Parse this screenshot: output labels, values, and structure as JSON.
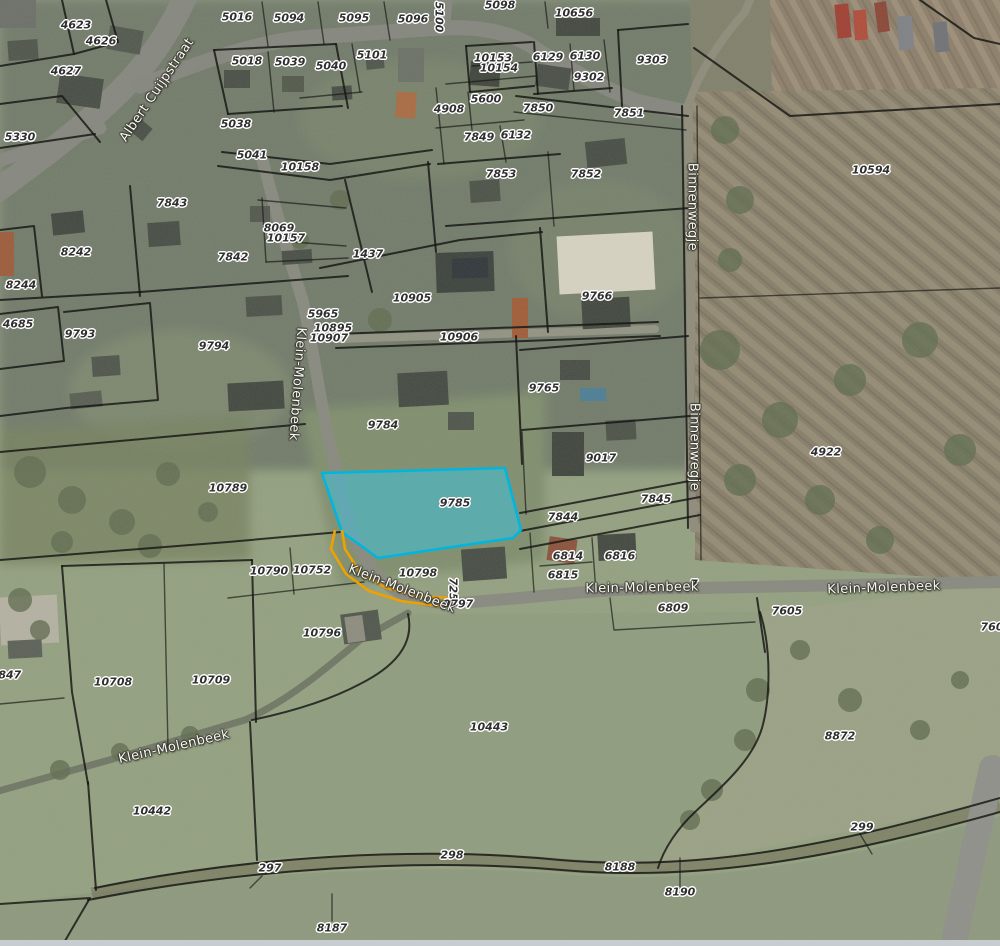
{
  "map": {
    "title": "Cadastral parcel map over aerial photo",
    "highlighted_parcel": {
      "id": "9785",
      "fill": "#40c1da",
      "stroke": "#00b6de"
    },
    "selection_outline_color": "#efa100",
    "parcel_label_color": "#2f2f2f",
    "road_label_color": "#f8f8f2",
    "parcel_labels": [
      {
        "id": "4623",
        "x": 76,
        "y": 25
      },
      {
        "id": "4626",
        "x": 101,
        "y": 41
      },
      {
        "id": "4627",
        "x": 66,
        "y": 71
      },
      {
        "id": "5330",
        "x": 20,
        "y": 137
      },
      {
        "id": "5016",
        "x": 237,
        "y": 17
      },
      {
        "id": "5094",
        "x": 289,
        "y": 18
      },
      {
        "id": "5095",
        "x": 354,
        "y": 18
      },
      {
        "id": "5096",
        "x": 413,
        "y": 19
      },
      {
        "id": "5100",
        "x": 439,
        "y": 17,
        "rot": 90
      },
      {
        "id": "5098",
        "x": 500,
        "y": 5
      },
      {
        "id": "10656",
        "x": 574,
        "y": 13
      },
      {
        "id": "5018",
        "x": 247,
        "y": 61
      },
      {
        "id": "5039",
        "x": 290,
        "y": 62
      },
      {
        "id": "5040",
        "x": 331,
        "y": 66
      },
      {
        "id": "5101",
        "x": 372,
        "y": 55
      },
      {
        "id": "5038",
        "x": 236,
        "y": 124
      },
      {
        "id": "5041",
        "x": 252,
        "y": 155
      },
      {
        "id": "10158",
        "x": 300,
        "y": 167
      },
      {
        "id": "10153",
        "x": 493,
        "y": 58
      },
      {
        "id": "10154",
        "x": 499,
        "y": 68
      },
      {
        "id": "6129",
        "x": 548,
        "y": 57
      },
      {
        "id": "6130",
        "x": 585,
        "y": 56
      },
      {
        "id": "9302",
        "x": 589,
        "y": 77
      },
      {
        "id": "9303",
        "x": 652,
        "y": 60
      },
      {
        "id": "5600",
        "x": 486,
        "y": 99
      },
      {
        "id": "4908",
        "x": 449,
        "y": 109
      },
      {
        "id": "7850",
        "x": 538,
        "y": 108
      },
      {
        "id": "7851",
        "x": 629,
        "y": 113
      },
      {
        "id": "7849",
        "x": 479,
        "y": 137
      },
      {
        "id": "6132",
        "x": 516,
        "y": 135
      },
      {
        "id": "7853",
        "x": 501,
        "y": 174
      },
      {
        "id": "7852",
        "x": 586,
        "y": 174
      },
      {
        "id": "10594",
        "x": 871,
        "y": 170
      },
      {
        "id": "7843",
        "x": 172,
        "y": 203
      },
      {
        "id": "8069",
        "x": 279,
        "y": 228
      },
      {
        "id": "10157",
        "x": 286,
        "y": 238
      },
      {
        "id": "7842",
        "x": 233,
        "y": 257
      },
      {
        "id": "8242",
        "x": 76,
        "y": 252
      },
      {
        "id": "8244",
        "x": 21,
        "y": 285
      },
      {
        "id": "1437",
        "x": 368,
        "y": 254
      },
      {
        "id": "4685",
        "x": 18,
        "y": 324
      },
      {
        "id": "9793",
        "x": 80,
        "y": 334
      },
      {
        "id": "9794",
        "x": 214,
        "y": 346
      },
      {
        "id": "10905",
        "x": 412,
        "y": 298
      },
      {
        "id": "5965",
        "x": 323,
        "y": 314
      },
      {
        "id": "10895",
        "x": 333,
        "y": 328
      },
      {
        "id": "10907",
        "x": 329,
        "y": 338
      },
      {
        "id": "10906",
        "x": 459,
        "y": 337
      },
      {
        "id": "9766",
        "x": 597,
        "y": 296
      },
      {
        "id": "9765",
        "x": 544,
        "y": 388
      },
      {
        "id": "9784",
        "x": 383,
        "y": 425
      },
      {
        "id": "4922",
        "x": 826,
        "y": 452
      },
      {
        "id": "9017",
        "x": 601,
        "y": 458
      },
      {
        "id": "10789",
        "x": 228,
        "y": 488
      },
      {
        "id": "9785",
        "x": 455,
        "y": 503
      },
      {
        "id": "7845",
        "x": 656,
        "y": 499
      },
      {
        "id": "7844",
        "x": 563,
        "y": 517
      },
      {
        "id": "10790",
        "x": 269,
        "y": 571
      },
      {
        "id": "10752",
        "x": 312,
        "y": 570
      },
      {
        "id": "10798",
        "x": 418,
        "y": 573
      },
      {
        "id": "6814",
        "x": 568,
        "y": 556
      },
      {
        "id": "6816",
        "x": 620,
        "y": 556
      },
      {
        "id": "6815",
        "x": 563,
        "y": 575
      },
      {
        "id": "7251",
        "x": 453,
        "y": 593,
        "rot": 90
      },
      {
        "id": "0797",
        "x": 458,
        "y": 604
      },
      {
        "id": "7",
        "x": 694,
        "y": 584
      },
      {
        "id": "6809",
        "x": 673,
        "y": 608
      },
      {
        "id": "7605",
        "x": 787,
        "y": 611
      },
      {
        "id": "760",
        "x": 992,
        "y": 627
      },
      {
        "id": "8872",
        "x": 840,
        "y": 736
      },
      {
        "id": "9847",
        "x": 6,
        "y": 675
      },
      {
        "id": "10708",
        "x": 113,
        "y": 682
      },
      {
        "id": "10709",
        "x": 211,
        "y": 680
      },
      {
        "id": "10796",
        "x": 322,
        "y": 633
      },
      {
        "id": "10443",
        "x": 489,
        "y": 727
      },
      {
        "id": "10442",
        "x": 152,
        "y": 811
      },
      {
        "id": "297",
        "x": 270,
        "y": 868
      },
      {
        "id": "298",
        "x": 452,
        "y": 855
      },
      {
        "id": "299",
        "x": 862,
        "y": 827
      },
      {
        "id": "8188",
        "x": 620,
        "y": 867
      },
      {
        "id": "8190",
        "x": 680,
        "y": 892
      },
      {
        "id": "8187",
        "x": 332,
        "y": 928
      }
    ],
    "road_labels": [
      {
        "name": "Albert Cuijpstraat",
        "x": 157,
        "y": 90,
        "rot": -56
      },
      {
        "name": "Binnenwegje",
        "x": 692,
        "y": 207,
        "rot": 90
      },
      {
        "name": "Binnenwegje",
        "x": 694,
        "y": 447,
        "rot": 90
      },
      {
        "name": "Klein-Molenbeek",
        "x": 297,
        "y": 384,
        "rot": 94
      },
      {
        "name": "Klein-Molenbeek",
        "x": 402,
        "y": 589,
        "rot": 21
      },
      {
        "name": "Klein-Molenbeek",
        "x": 642,
        "y": 588,
        "rot": -1
      },
      {
        "name": "Klein-Molenbeek",
        "x": 884,
        "y": 588,
        "rot": -2
      },
      {
        "name": "Klein-Molenbeek",
        "x": 174,
        "y": 747,
        "rot": -13
      }
    ]
  }
}
